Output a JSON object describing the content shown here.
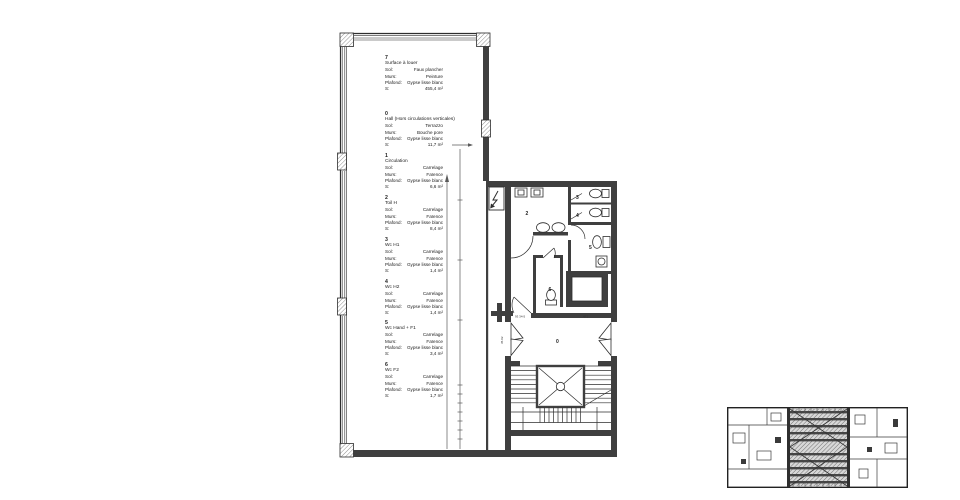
{
  "legend": [
    {
      "number": "7",
      "name": "Surface à louer",
      "rows": [
        {
          "label": "Sol:",
          "value": "Faux plancher"
        },
        {
          "label": "Murs:",
          "value": "Peinture"
        },
        {
          "label": "Plafond:",
          "value": "Gypse lisse blanc"
        },
        {
          "label": "S:",
          "value": "455,4 m²"
        }
      ]
    },
    {
      "number": "0",
      "name": "Hall (Hors circulations verticales)",
      "rows": [
        {
          "label": "Sol:",
          "value": "Terrazzo"
        },
        {
          "label": "Murs:",
          "value": "Bouche pore"
        },
        {
          "label": "Plafond:",
          "value": "Gypse lisse blanc"
        },
        {
          "label": "S:",
          "value": "11,7 m²"
        }
      ]
    },
    {
      "number": "1",
      "name": "Circulation",
      "rows": [
        {
          "label": "Sol:",
          "value": "Carrelage"
        },
        {
          "label": "Murs:",
          "value": "Faïence"
        },
        {
          "label": "Plafond:",
          "value": "Gypse lisse blanc"
        },
        {
          "label": "S:",
          "value": "6,6 m²"
        }
      ]
    },
    {
      "number": "2",
      "name": "Toil H",
      "rows": [
        {
          "label": "Sol:",
          "value": "Carrelage"
        },
        {
          "label": "Murs:",
          "value": "Faïence"
        },
        {
          "label": "Plafond:",
          "value": "Gypse lisse blanc"
        },
        {
          "label": "S:",
          "value": "8,4 m²"
        }
      ]
    },
    {
      "number": "3",
      "name": "Wc H1",
      "rows": [
        {
          "label": "Sol:",
          "value": "Carrelage"
        },
        {
          "label": "Murs:",
          "value": "Faïence"
        },
        {
          "label": "Plafond:",
          "value": "Gypse lisse blanc"
        },
        {
          "label": "S:",
          "value": "1,4 m²"
        }
      ]
    },
    {
      "number": "4",
      "name": "Wc H2",
      "rows": [
        {
          "label": "Sol:",
          "value": "Carrelage"
        },
        {
          "label": "Murs:",
          "value": "Faïence"
        },
        {
          "label": "Plafond:",
          "value": "Gypse lisse blanc"
        },
        {
          "label": "S:",
          "value": "1,4 m²"
        }
      ]
    },
    {
      "number": "5",
      "name": "Wc Hand + F1",
      "rows": [
        {
          "label": "Sol:",
          "value": "Carrelage"
        },
        {
          "label": "Murs:",
          "value": "Faïence"
        },
        {
          "label": "Plafond:",
          "value": "Gypse lisse blanc"
        },
        {
          "label": "S:",
          "value": "3,4 m²"
        }
      ]
    },
    {
      "number": "6",
      "name": "Wc F2",
      "rows": [
        {
          "label": "Sol:",
          "value": "Carrelage"
        },
        {
          "label": "Murs:",
          "value": "Faïence"
        },
        {
          "label": "Plafond:",
          "value": "Gypse lisse blanc"
        },
        {
          "label": "S:",
          "value": "1,7 m²"
        }
      ]
    }
  ],
  "plan_labels": {
    "hall": "0",
    "toil_h": "2",
    "wc_h1": "3",
    "wc_h2": "4",
    "wc_hand_f1": "5",
    "wc_f2": "6"
  },
  "door_tags": {
    "hall_left": "93 34-5",
    "hall_right": "4F1",
    "hall_side": "35.02"
  },
  "colors": {
    "wall": "#3f3f3f",
    "line": "#2e2e2e",
    "hatch": "#9a9a9a",
    "background": "#ffffff"
  }
}
